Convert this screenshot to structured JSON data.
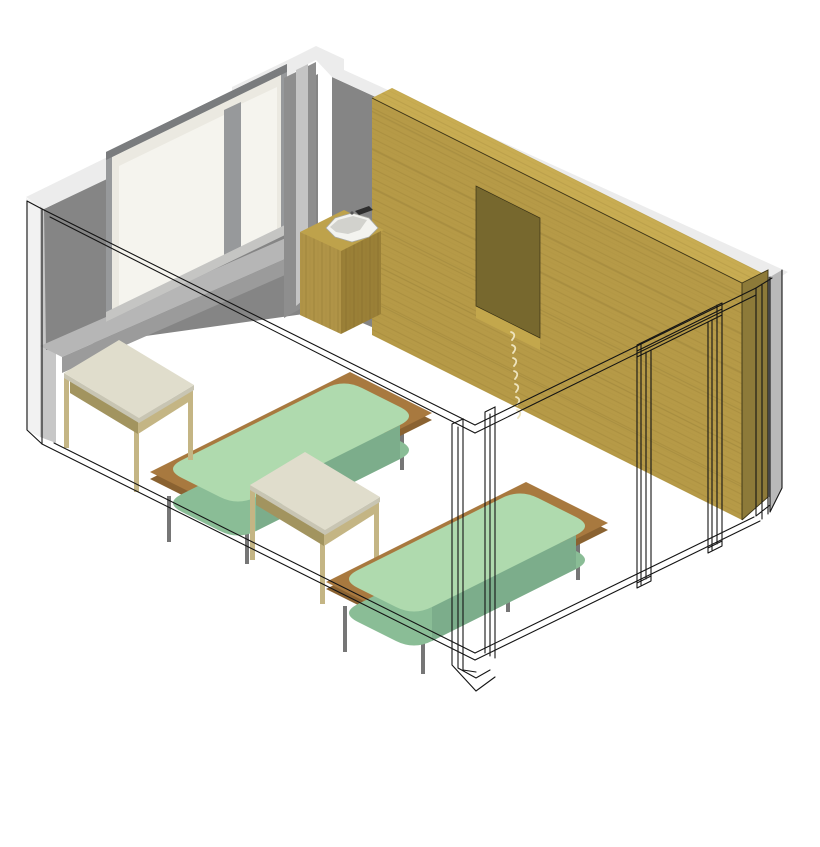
{
  "scene": {
    "description": "Isometric cutaway 3D rendering of a bedroom: grey window wall, full-height oak built-in wardrobe with open niche and drawer stack, corner sink counter with white basin, two platform beds with pale-green rounded mattresses, two square wooden side tables, and the removed front walls with door opening drawn as thin black wireframe on a white floor.",
    "view": "axonometric cutaway",
    "background": "#ffffff"
  },
  "counts": {
    "beds": 2,
    "side_tables": 2,
    "windows": 1,
    "window_panes": 2,
    "doors": 1,
    "basins": 1,
    "drawer_handles": 7,
    "niches": 1
  },
  "objects": [
    {
      "name": "left-wall",
      "desc": "grey wall with window, white cut cap on top"
    },
    {
      "name": "window",
      "desc": "recessed two-pane window with white frame and grey mullion"
    },
    {
      "name": "window-ledge",
      "desc": "light grey ledge running along the base of the window wall"
    },
    {
      "name": "corner-pier",
      "desc": "wall pier at the far corner"
    },
    {
      "name": "right-wall",
      "desc": "grey wall behind the built-in wardrobe"
    },
    {
      "name": "wardrobe",
      "desc": "full-width oak wardrobe with open niche and drawer stack of seven handles"
    },
    {
      "name": "sink-counter",
      "desc": "oak counter with inset white corner basin and dark faucet"
    },
    {
      "name": "door-frame",
      "desc": "door opening of the removed front wall drawn as black wireframe"
    },
    {
      "name": "bed-1",
      "desc": "platform bed, pale green rounded mattress, wooden base, thin grey legs"
    },
    {
      "name": "bed-2",
      "desc": "platform bed, pale green rounded mattress, wooden base, thin grey legs"
    },
    {
      "name": "table-1",
      "desc": "square side table, cream top, wooden legs and lower shelf"
    },
    {
      "name": "table-2",
      "desc": "square side table, cream top, wooden legs and lower shelf"
    },
    {
      "name": "cut-walls-outline",
      "desc": "removed front walls and corner pier shown as thin black outlines"
    }
  ],
  "colors": {
    "background": "#ffffff",
    "capWhite": "#ececec",
    "outerStrip": "#f2f2f2",
    "grayStrip": "#c7c7c7",
    "rightStrip": "#b9b9b9",
    "wallDark": "#858585",
    "pier": "#8e8e8e",
    "pierLight": "#c4c4c4",
    "ledgeTop": "#b6b6b6",
    "ledgeFace": "#9b9b9b",
    "revealDark": "#7a7c7e",
    "frameWhite": "#ebe9e1",
    "glazing": "#f5f4ee",
    "mullion": "#97999b",
    "sillLight": "#c5c5c3",
    "woodTop": "#c8ac52",
    "woodFront": "#b69a47",
    "woodSide": "#8d7a39",
    "nicheDark": "#77682e",
    "nicheSill": "#c3a74c",
    "counterTop": "#bea24b",
    "counterFrontL": "#b09447",
    "counterFrontR": "#9a8037",
    "basin": "#f3f3ef",
    "basinShadow": "#d2d2cd",
    "faucet": "#2e2e2e",
    "handle": "#eee4bd",
    "mattressTop": "#afdaae",
    "mattressSide": "#8abd96",
    "mattressSideDark": "#7cad8b",
    "platform": "#a8793f",
    "platformDark": "#8a6231",
    "legGray": "#767676",
    "tableTop": "#e0ddcc",
    "tableEdge": "#c8c5b3",
    "tableWood": "#c4b584",
    "tableWoodDark": "#a2945f",
    "shelf": "#d7d3bf",
    "line": "#141414",
    "woodEdge": "#3c3416"
  }
}
